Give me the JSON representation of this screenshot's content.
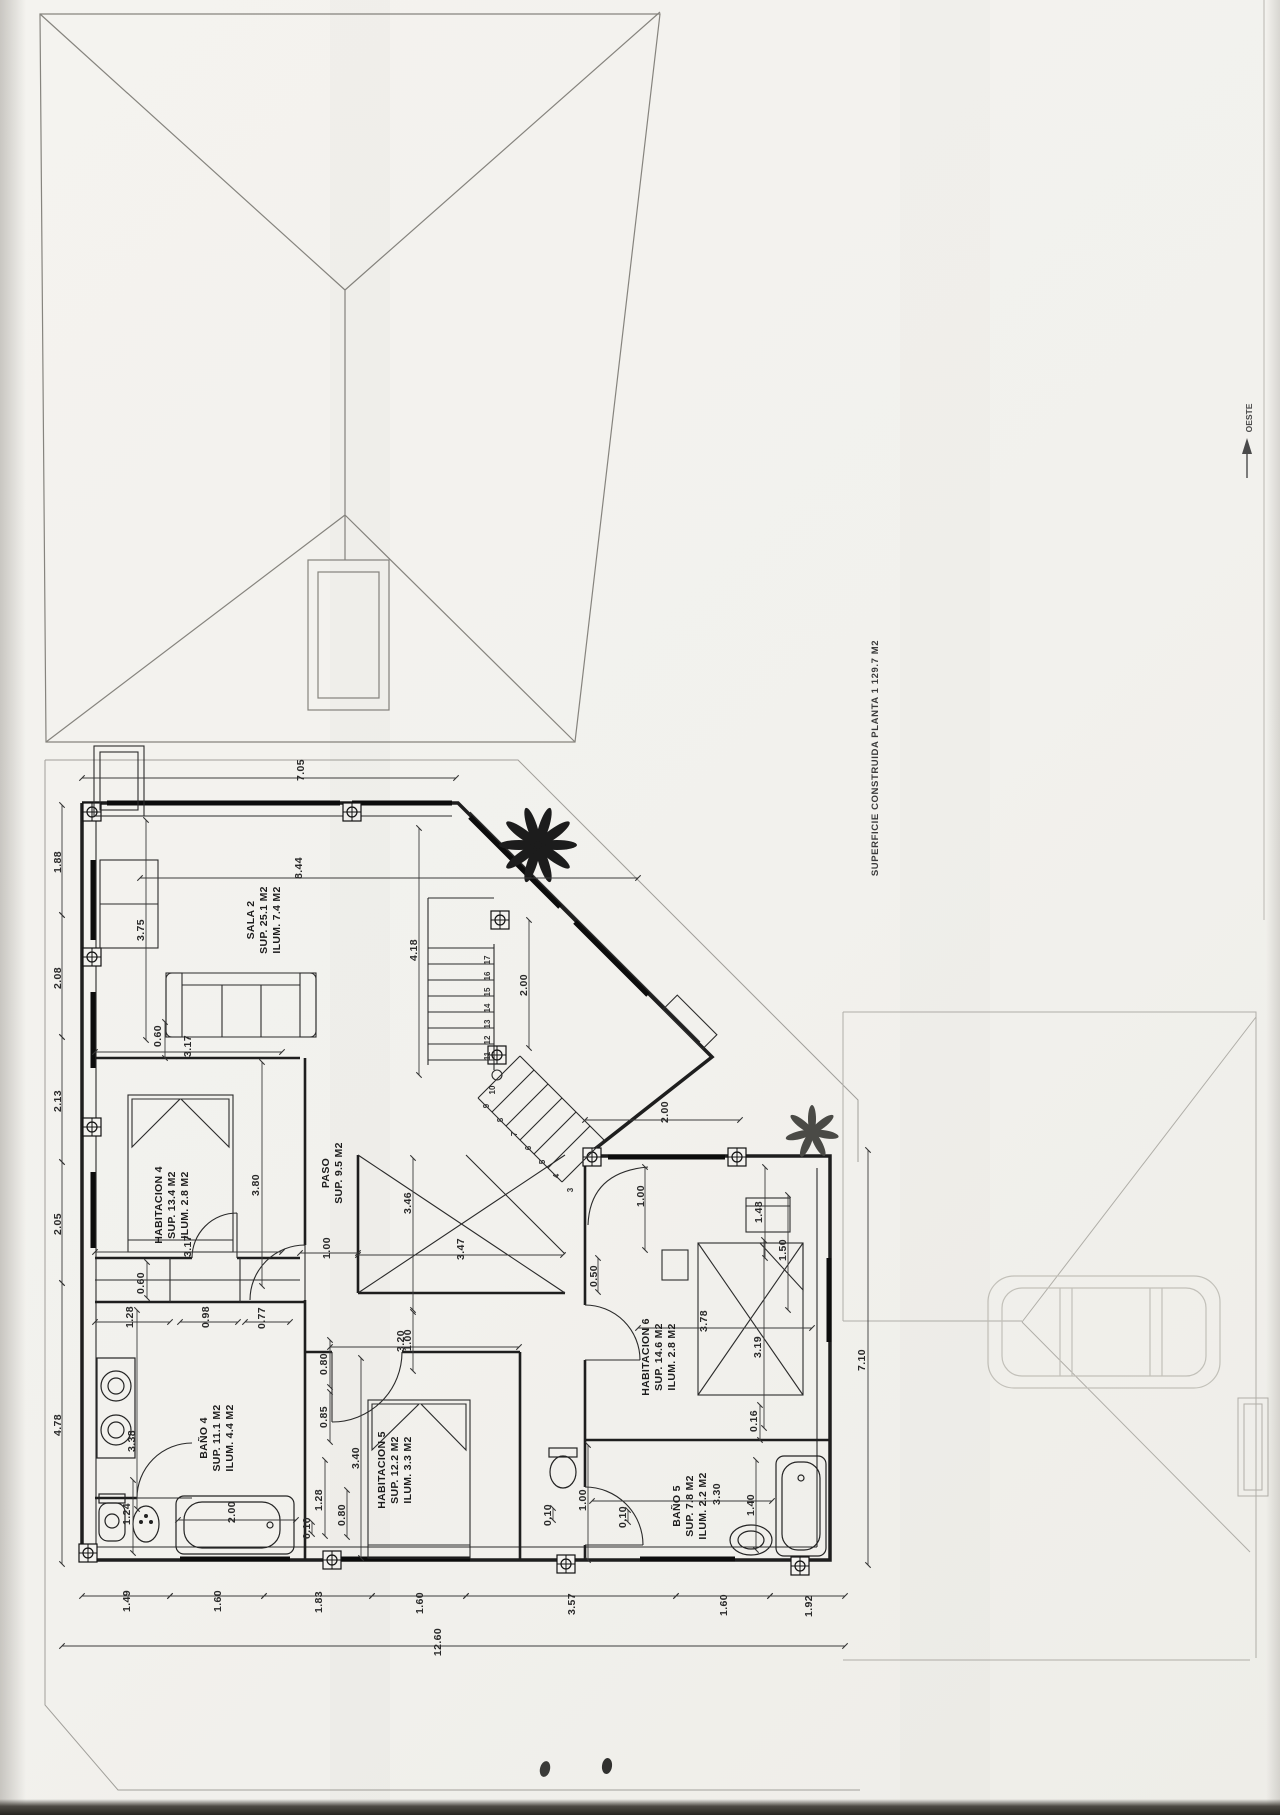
{
  "labels": {
    "superficie": "SUPERFICIE CONSTRUIDA PLANTA 1 129.7 M2",
    "orientation": "OESTE"
  },
  "rooms": [
    {
      "name": "SALA 2",
      "sup": "SUP. 25.1 M2",
      "ilum": "ILUM. 7.4 M2"
    },
    {
      "name": "HABITACION 4",
      "sup": "SUP. 13.4 M2",
      "ilum": "ILUM. 2.8 M2"
    },
    {
      "name": "PASO",
      "sup": "SUP. 9.5 M2",
      "ilum": ""
    },
    {
      "name": "BAÑO 4",
      "sup": "SUP. 11.1 M2",
      "ilum": "ILUM. 4.4 M2"
    },
    {
      "name": "HABITACION 5",
      "sup": "SUP. 12.2 M2",
      "ilum": "ILUM. 3.3 M2"
    },
    {
      "name": "HABITACION 6",
      "sup": "SUP. 14.6 M2",
      "ilum": "ILUM. 2.8 M2"
    },
    {
      "name": "BAÑO 5",
      "sup": "SUP. 7.8 M2",
      "ilum": "ILUM. 2.2 M2"
    }
  ],
  "dims": [
    "7.05",
    "8.44",
    "3.75",
    "4.18",
    "2.00",
    "1.88",
    "2.08",
    "2.13",
    "2.05",
    "4.78",
    "0.60",
    "3.17",
    "3.17",
    "3.80",
    "0.60",
    "1.28",
    "0.98",
    "0.77",
    "1.00",
    "3.47",
    "3.46",
    "1.00",
    "0.80",
    "0.85",
    "3.38",
    "1.24",
    "2.00",
    "0.10",
    "1.28",
    "0.80",
    "3.20",
    "3.40",
    "2.00",
    "1.00",
    "1.48",
    "1.50",
    "0.50",
    "3.78",
    "3.19",
    "0.16",
    "1.00",
    "0.10",
    "0.10",
    "3.30",
    "1.40",
    "7.10",
    "1.49",
    "1.60",
    "1.83",
    "1.60",
    "3.57",
    "1.60",
    "1.92",
    "12.60"
  ],
  "stair_steps": [
    "17",
    "16",
    "15",
    "14",
    "13",
    "12",
    "11",
    "10",
    "9",
    "8",
    "7",
    "6",
    "5",
    "4",
    "3"
  ]
}
